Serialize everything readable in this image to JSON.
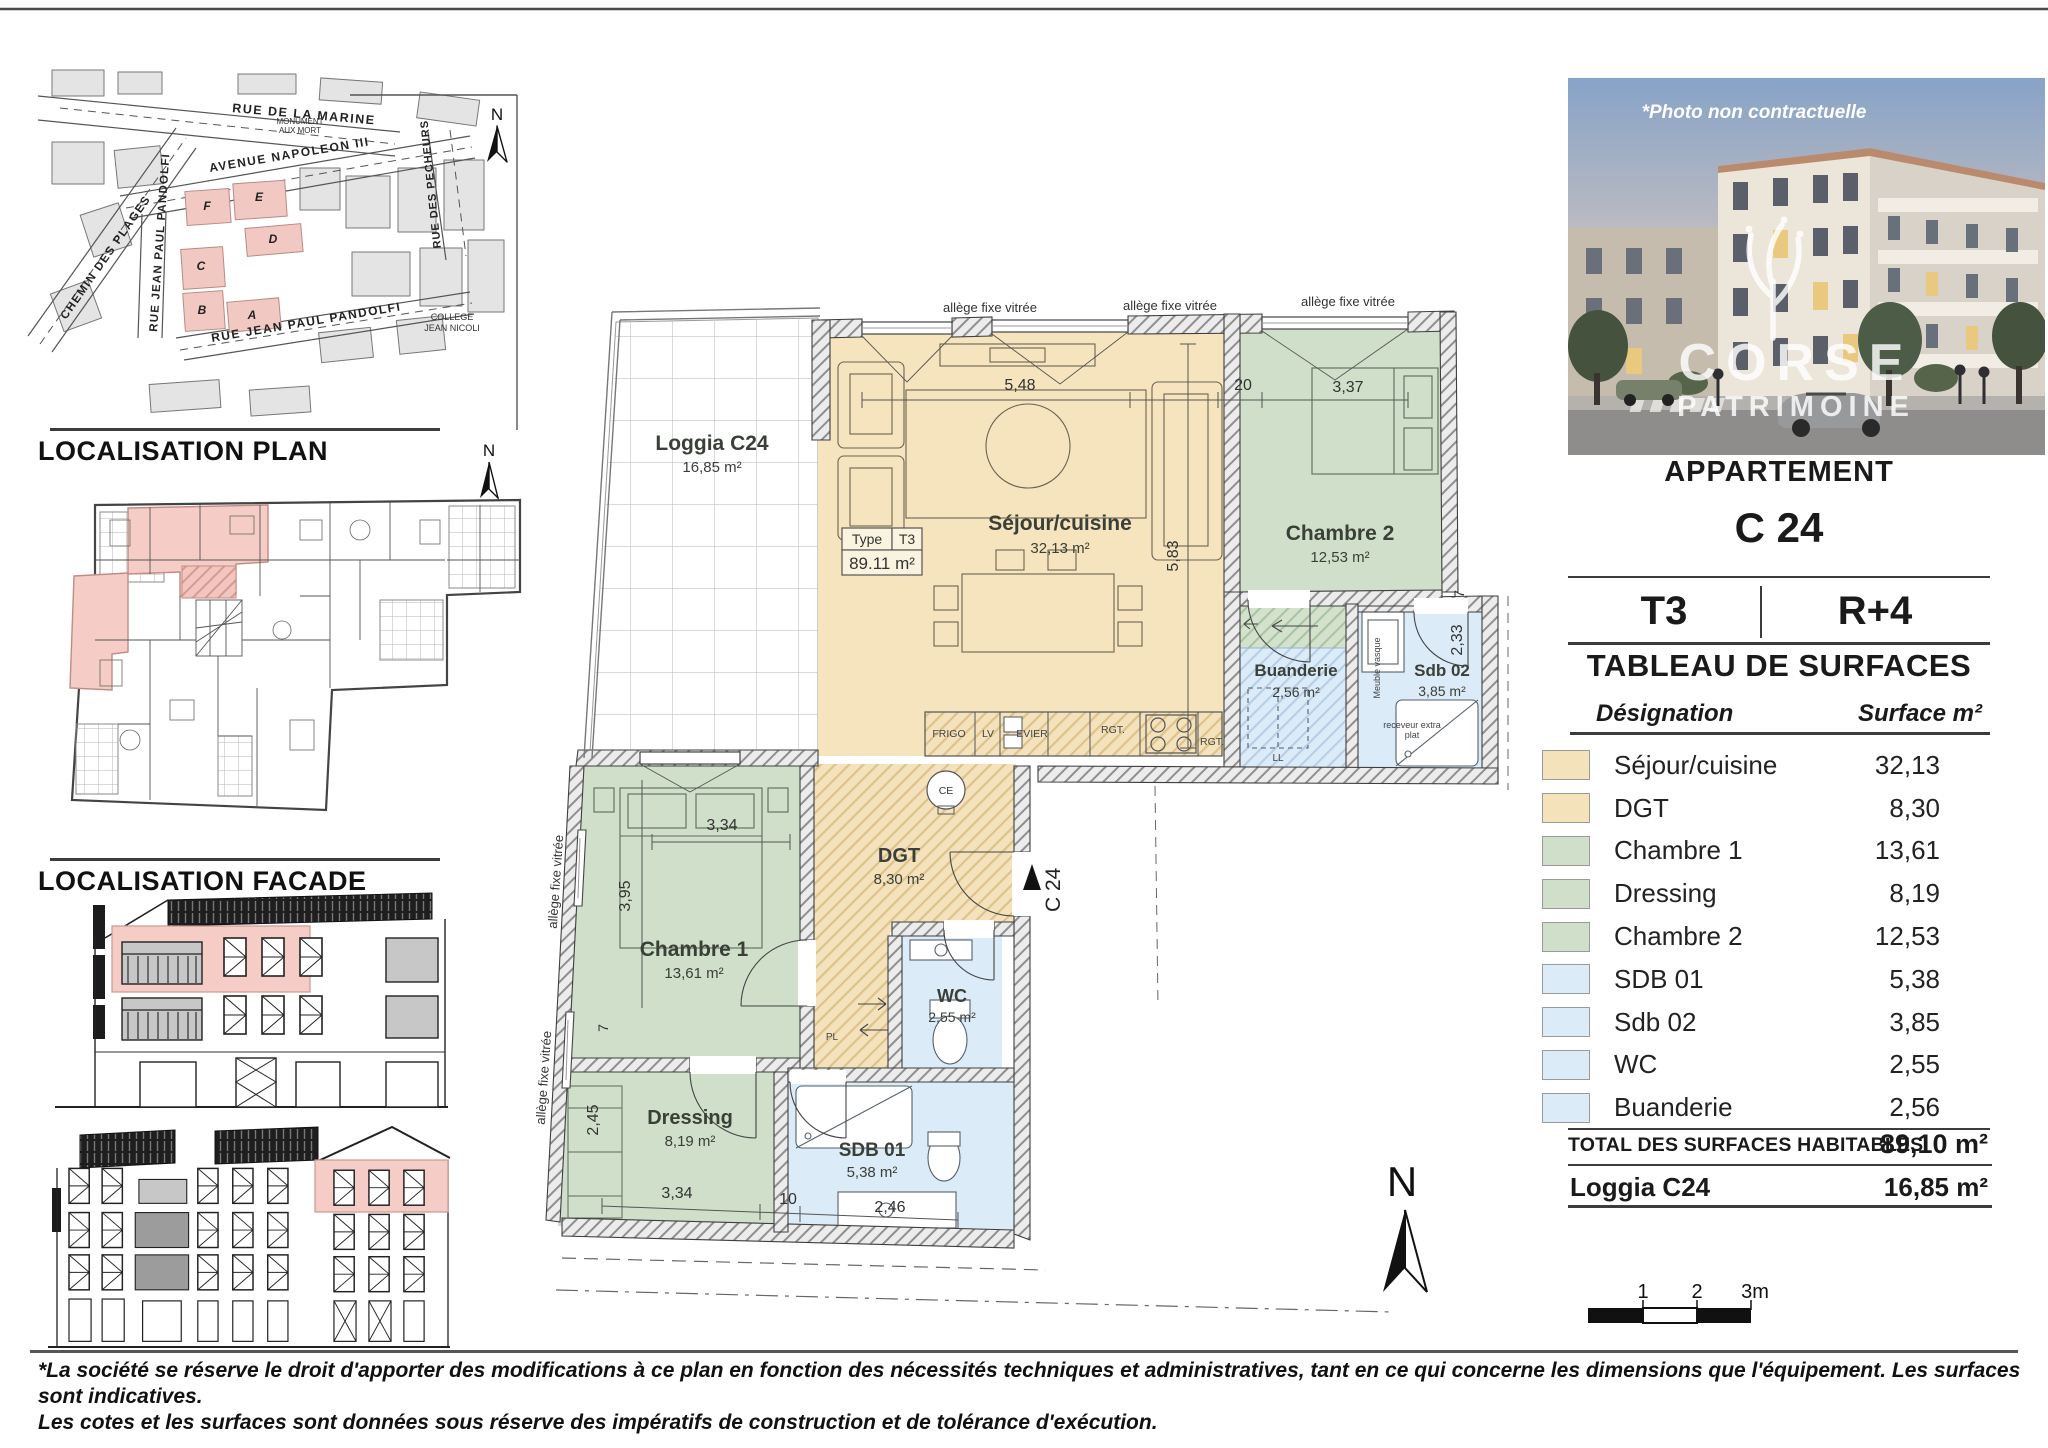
{
  "sheet": {
    "localisation_plan_title": "LOCALISATION PLAN",
    "localisation_facade_title": "LOCALISATION FACADE",
    "north": "N",
    "disclaimer_line1": "*La société se réserve le droit d'apporter des modifications à ce plan en fonction des nécessités techniques et administratives, tant en ce qui concerne les dimensions que l'équipement. Les surfaces sont indicatives.",
    "disclaimer_line2": "Les cotes et les surfaces sont données sous réserve des impératifs de construction et de tolérance d'exécution."
  },
  "map": {
    "streets": {
      "rue_de_la_marine": "RUE DE LA MARINE",
      "avenue_napoleon": "AVENUE   NAPOLEON   III",
      "chemin_des_plages": "CHEMIN   DES   PLAGES",
      "rue_pandolfi_vertical": "RUE   JEAN   PAUL   PANDOLFI",
      "rue_pandolfi_diagonal": "RUE   JEAN   PAUL   PANDOLFI",
      "rue_des_pecheurs": "RUE   DES   PECHEURS",
      "monument_line1": "MONUMENT",
      "monument_line2": "AUX MORT",
      "college_line1": "COLLEGE",
      "college_line2": "JEAN NICOLI"
    },
    "blocks": {
      "a": "A",
      "b": "B",
      "c": "C",
      "d": "D",
      "e": "E",
      "f": "F"
    }
  },
  "plan": {
    "allege_label": "allège fixe vitrée",
    "type_box": {
      "type_label": "Type",
      "type_value": "T3",
      "area": "89.11 m²"
    },
    "entrance_label": "C 24",
    "rooms": {
      "loggia": {
        "name": "Loggia C24",
        "area": "16,85 m²"
      },
      "sejour": {
        "name": "Séjour/cuisine",
        "area": "32,13 m²"
      },
      "chambre2": {
        "name": "Chambre 2",
        "area": "12,53 m²"
      },
      "buanderie": {
        "name": "Buanderie",
        "area": "2,56 m²"
      },
      "sdb02": {
        "name": "Sdb 02",
        "area": "3,85 m²"
      },
      "dgt": {
        "name": "DGT",
        "area": "8,30 m²"
      },
      "chambre1": {
        "name": "Chambre 1",
        "area": "13,61 m²"
      },
      "wc": {
        "name": "WC",
        "area": "2,55 m²"
      },
      "dressing": {
        "name": "Dressing",
        "area": "8,19 m²"
      },
      "sdb01": {
        "name": "SDB 01",
        "area": "5,38 m²"
      }
    },
    "fixtures": {
      "frigo": "FRIGO",
      "lv": "LV",
      "evier": "EVIER",
      "rgt1": "RGT.",
      "rgt2": "RGT.",
      "ll": "LL",
      "ce": "CE",
      "pl": "PL",
      "meuble_vasque": "Meuble vasque",
      "receveur_line1": "receveur extra",
      "receveur_line2": "plat"
    },
    "dims": {
      "d548": "5,48",
      "d20": "20",
      "d337": "3,37",
      "d583": "5,83",
      "d7a": "7",
      "d233": "2,33",
      "d334a": "3,34",
      "d395": "3,95",
      "d7b": "7",
      "d245": "2,45",
      "d334b": "3,34",
      "d10": "10",
      "d246": "2,46"
    }
  },
  "photo": {
    "caption": "*Photo non contractuelle",
    "brand_line1": "CORSE",
    "brand_line2": "PATRIMOINE"
  },
  "panel": {
    "apartment_label": "APPARTEMENT",
    "apartment_code": "C 24",
    "type": "T3",
    "floor": "R+4",
    "table_title": "TABLEAU DE SURFACES",
    "col_designation": "Désignation",
    "col_surface": "Surface m²",
    "rows": [
      {
        "name": "Séjour/cuisine",
        "value": "32,13",
        "color": "#f4e2ba"
      },
      {
        "name": "DGT",
        "value": "8,30",
        "color": "#f4e2ba"
      },
      {
        "name": "Chambre 1",
        "value": "13,61",
        "color": "#cfdfca"
      },
      {
        "name": "Dressing",
        "value": "8,19",
        "color": "#cfdfca"
      },
      {
        "name": "Chambre 2",
        "value": "12,53",
        "color": "#cfdfca"
      },
      {
        "name": "SDB 01",
        "value": "5,38",
        "color": "#dcebf8"
      },
      {
        "name": "Sdb 02",
        "value": "3,85",
        "color": "#dcebf8"
      },
      {
        "name": "WC",
        "value": "2,55",
        "color": "#dcebf8"
      },
      {
        "name": "Buanderie",
        "value": "2,56",
        "color": "#dcebf8"
      }
    ],
    "total_label": "TOTAL DES SURFACES HABITABLES",
    "total_value": "89,10 m²",
    "loggia_label": "Loggia C24",
    "loggia_value": "16,85 m²"
  },
  "scale_bar": {
    "t1": "1",
    "t2": "2",
    "t3": "3m"
  },
  "colors": {
    "sejour_fill": "#f4e2ba",
    "chambre_fill": "#cfdfca",
    "bath_fill": "#dcebf8",
    "highlight_pink": "#f5cdc6",
    "wall_hatch": "#ececec",
    "accent_dark": "#3c3c3c"
  }
}
